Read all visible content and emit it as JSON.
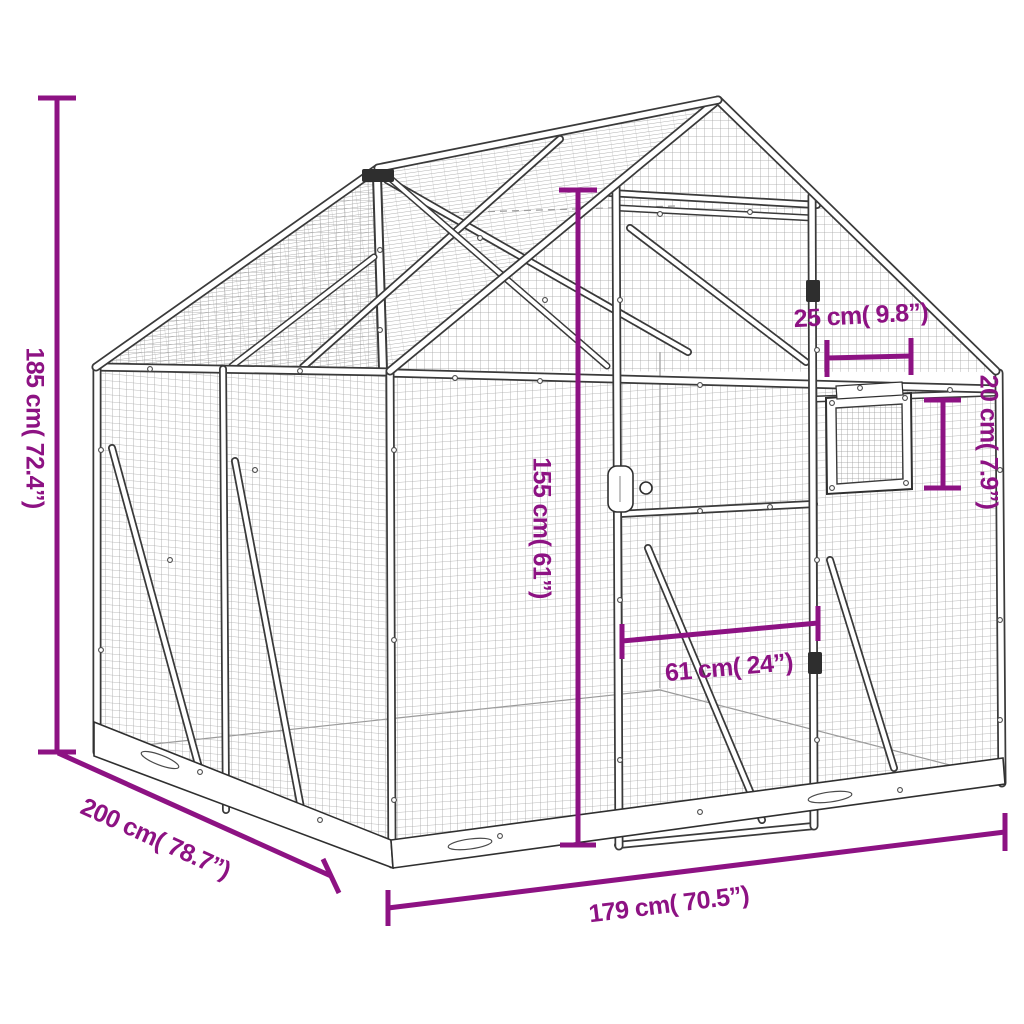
{
  "page": {
    "background": "#ffffff"
  },
  "diagram": {
    "subject": "aluminium aviary cage wireframe with dimension annotations",
    "accent_color": "#8D1283",
    "frame_color": "#3a3a3a",
    "mesh_color": "#a9a9a9"
  },
  "dimensions": [
    {
      "id": "overall-height",
      "label": "185 cm( 72.4”)",
      "value_cm": 185,
      "value_in": 72.4
    },
    {
      "id": "depth",
      "label": "200 cm( 78.7”)",
      "value_cm": 200,
      "value_in": 78.7
    },
    {
      "id": "front-width",
      "label": "179 cm( 70.5”)",
      "value_cm": 179,
      "value_in": 70.5
    },
    {
      "id": "door-height",
      "label": "155 cm( 61”)",
      "value_cm": 155,
      "value_in": 61
    },
    {
      "id": "door-width",
      "label": "61 cm( 24”)",
      "value_cm": 61,
      "value_in": 24
    },
    {
      "id": "window-width",
      "label": "25 cm( 9.8”)",
      "value_cm": 25,
      "value_in": 9.8
    },
    {
      "id": "window-height",
      "label": "20 cm( 7.9”)",
      "value_cm": 20,
      "value_in": 7.9
    }
  ]
}
